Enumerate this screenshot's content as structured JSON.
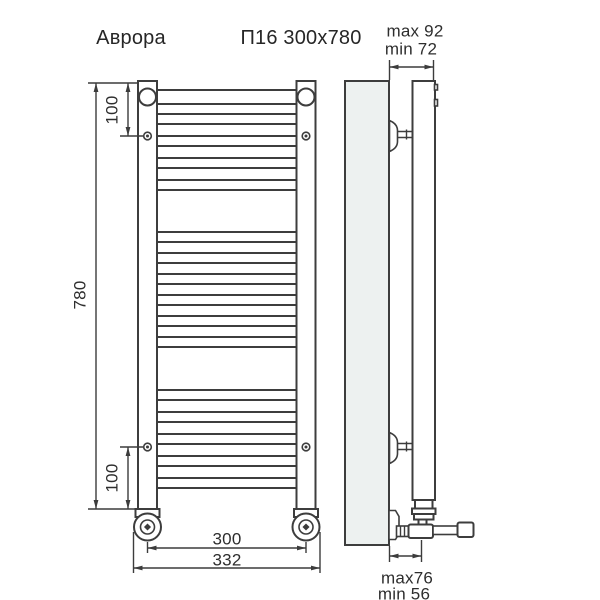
{
  "title": {
    "product": "Аврора",
    "model": "П16 300x780"
  },
  "dimensions": {
    "height": "780",
    "offset_top": "100",
    "offset_bottom": "100",
    "width_axis": "300",
    "width_overall": "332",
    "depth_top_max": "max 92",
    "depth_top_min": "min 72",
    "depth_bottom_max": "max76",
    "depth_bottom_min": "min 56"
  },
  "figure": {
    "type": "technical-drawing",
    "object": "ladder-towel-rail",
    "views": [
      "front",
      "side"
    ],
    "rung_count": 16,
    "rung_groups": [
      5,
      6,
      5
    ],
    "colors": {
      "line": "#3d3d3d",
      "wall_fill": "#edf1f0",
      "background": "#ffffff",
      "text": "#2e2e2e"
    }
  }
}
